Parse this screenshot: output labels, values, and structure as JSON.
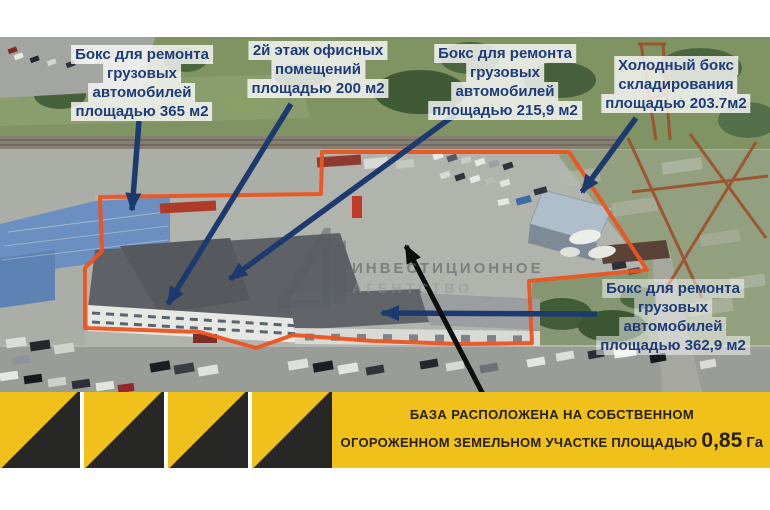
{
  "colors": {
    "outline_red": "#ec5420",
    "arrow_navy": "#1d3a6e",
    "banner_yellow": "#f0c11a",
    "label_text_navy": "#1e3c78"
  },
  "labels": [
    {
      "id": "box-365",
      "lines": [
        "Бокс для ремонта",
        "грузовых",
        "автомобилей",
        "площадью 365 м2"
      ]
    },
    {
      "id": "office-200",
      "lines": [
        "2й этаж офисных",
        "помещений",
        "площадью 200 м2"
      ]
    },
    {
      "id": "box-215",
      "lines": [
        "Бокс для ремонта",
        "грузовых",
        "автомобилей",
        "площадью 215,9 м2"
      ]
    },
    {
      "id": "cold-box-203",
      "lines": [
        "Холодный бокс",
        "складирования",
        "площадью 203.7м2"
      ]
    },
    {
      "id": "box-362",
      "lines": [
        "Бокс для ремонта",
        "грузовых",
        "автомобилей",
        "площадью 362,9 м2"
      ]
    }
  ],
  "watermark": {
    "line1": "ИНВЕСТИЦИОННОЕ",
    "line2": "АГЕНТСТВО"
  },
  "banner": {
    "line1": "БАЗА РАСПОЛОЖЕНА НА СОБСТВЕННОМ",
    "line2_prefix": "ОГОРОЖЕННОМ ЗЕМЕЛЬНОМ УЧАСТКЕ ПЛОЩАДЬЮ",
    "line2_value": "0,85",
    "line2_unit": "Га"
  }
}
